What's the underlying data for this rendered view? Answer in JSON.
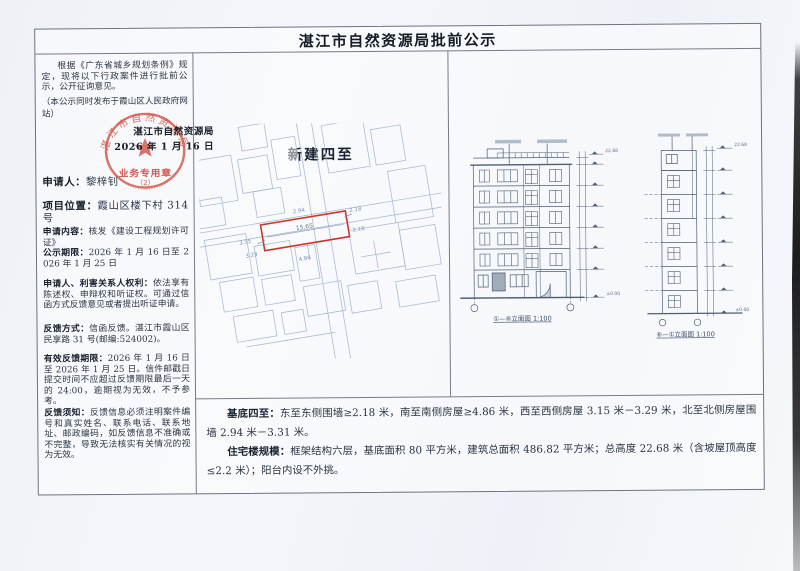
{
  "page": {
    "title": "湛江市自然资源局批前公示"
  },
  "left_panel": {
    "intro": "根据《广东省城乡规划条例》规定，现将以下行政案件进行批前公示，公开征询意见。",
    "intro_note": "（本公示同时发布于霞山区人民政府网站）",
    "stamp": {
      "agency_line": "湛江市自然资源局",
      "date_line": "2026 年 1 月 16 日",
      "seal_ring_text": "湛江市自然资源局",
      "seal_label": "业务专用章",
      "seal_number": "（2）"
    },
    "fields": [
      {
        "label": "申请人：",
        "value": "黎梓钊"
      },
      {
        "label": "项目位置：",
        "value": "霞山区楼下村 314 号"
      },
      {
        "label": "申请内容：",
        "value": "核发《建设工程规划许可证》"
      },
      {
        "label": "公示期限：",
        "value": "2026 年 1 月 16 日至 2026 年 1 月 25 日"
      },
      {
        "label": "申请人、利害关系人权利：",
        "value": "依法享有陈述权、申辩权和听证权。可通过信函方式反馈意见或者提出听证申请。"
      },
      {
        "label": "反馈方式：",
        "value": "信函反馈。湛江市霞山区民享路 31 号(邮编:524002)。"
      },
      {
        "label": "有效反馈期限：",
        "value": "2026 年 1 月 16 日至 2026 年 1 月 25 日。信件邮戳日提交时间不应超过反馈期限最后一天的 24:00，逾期视为无效，不予参考。"
      },
      {
        "label": "反馈须知：",
        "value": "反馈信息必须注明案件编号和真实姓名、联系电话、联系地址、邮政编码，如反馈信息不准确或不完整，导致无法核实有关情况的视为无效。"
      }
    ]
  },
  "site_plan": {
    "title": "新建四至",
    "plot_length": "15.65",
    "dim_east_1": "2.18",
    "dim_east_2": "2.18",
    "dim_west_1": "3.15",
    "dim_west_2": "3.29",
    "dim_south": "4.86",
    "dim_north": "2.94"
  },
  "elevations": {
    "front_caption": "①—⑥立面图 1:100",
    "side_caption": "⑥—①立面图 1:100",
    "top_level": "22.68",
    "zero_level": "±0.00"
  },
  "bottom_panel": {
    "p1_label": "基底四至：",
    "p1_text": "东至东侧围墙≥2.18 米，南至南侧房屋≥4.86 米，西至西侧房屋 3.15 米－3.29 米，北至北侧房屋围墙 2.94 米－3.31 米。",
    "p2_label": "住宅楼规模：",
    "p2_text": "框架结构六层，基底面积 80 平方米，建筑总面积 486.82 平方米；总高度 22.68 米（含坡屋顶高度≤2.2 米）；阳台内设不外挑。"
  },
  "colors": {
    "seal_red": "#cf4437",
    "plot_red": "#c9372c",
    "drawing_line": "#4e5f75",
    "map_line": "#a3b4cf",
    "border_gray": "#6d737d",
    "paper": "#f3f6fa"
  }
}
